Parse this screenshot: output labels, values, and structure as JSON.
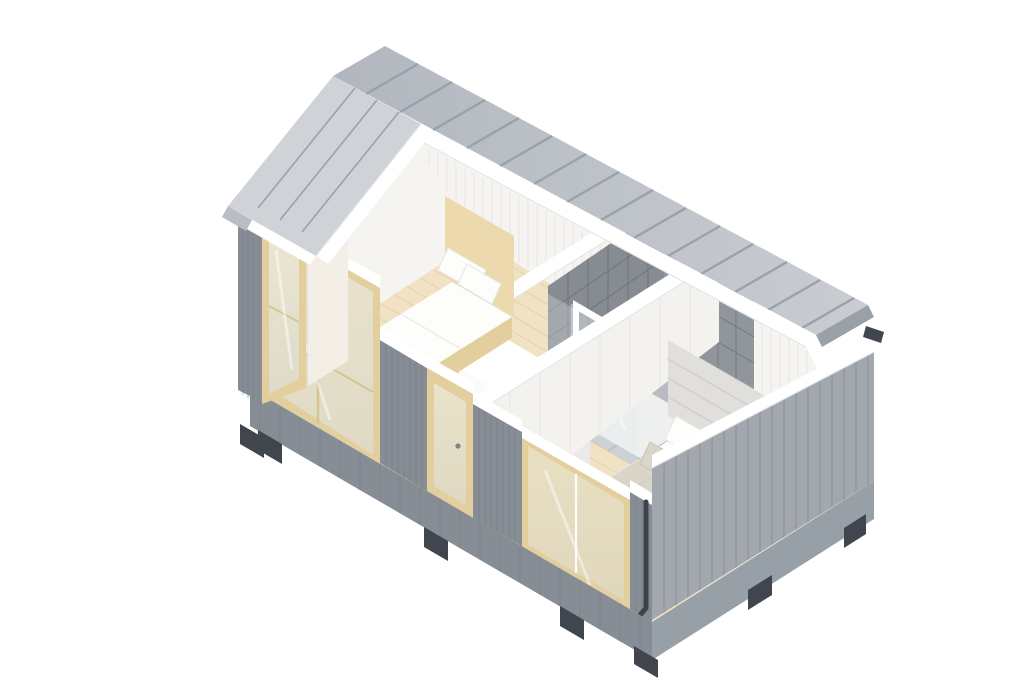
{
  "meta": {
    "description": "Isometric cutaway 3D rendering of a tiny modular house with two bedrooms and a central bathroom",
    "width_px": 1024,
    "height_px": 683
  },
  "palette": {
    "background": "#ffffff",
    "roof_metal_light": "#cfd3d8",
    "roof_metal": "#b9bec5",
    "roof_seam": "#9aa1aa",
    "roof_end_cap": "#9aa0a8",
    "trim_white": "#ffffff",
    "cut_edge_shadow": "#e4e7ea",
    "siding_gray": "#98a0a7",
    "siding_gray_dark": "#868d95",
    "siding_line": "#757c84",
    "interior_white": "#f5f4f1",
    "panel_line": "#e7e6e1",
    "gable_interior": "#f3efe6",
    "floor_wood": "#f1e2c4",
    "floor_plank_line": "#e0cda7",
    "tile_dark": "#878c93",
    "tile_dark_2": "#91969d",
    "tile_grout": "#61666d",
    "tile_floor": "#b8bcc1",
    "glass_tint": "#e4ebee",
    "wood_light": "#ecdaae",
    "wood_frame": "#e3cf9e",
    "bedding_white": "#fdfdfc",
    "bedding_greige": "#d9d6c9",
    "bedding_greige_dark": "#cbc8b9",
    "headboard_gray": "#e0dfdb",
    "rug_gray": "#d6d8d9",
    "foot_dark": "#41464e",
    "chrome": "#aeb4ba"
  },
  "scene": {
    "building": "tiny-house cutaway, gable standing-seam metal roof with front slope removed",
    "exterior": {
      "cladding": "gray vertical wood siding",
      "base": "raised platform on dark foundation feet",
      "details": [
        "white cut edges",
        "corner downspout",
        "white barge board",
        "roof end gutter hook"
      ]
    },
    "rooms": [
      {
        "name": "bedroom-1",
        "furniture": [
          "single bed",
          "tall wood headboard",
          "white duvet",
          "two white pillows"
        ],
        "features": [
          "gable-end window",
          "front glazed sliding door",
          "wood plank floor",
          "white paneled walls"
        ]
      },
      {
        "name": "bathroom",
        "furniture": [
          "walk-in shower",
          "glass shower screen",
          "chrome shower fixture",
          "white vanity unit"
        ],
        "features": [
          "dark gray wall tiles",
          "gray floor tiles",
          "small wood-framed back window"
        ]
      },
      {
        "name": "hallway",
        "furniture": [
          "white wardrobe with wood side panel"
        ],
        "features": [
          "glazed entrance door with wood frame"
        ]
      },
      {
        "name": "bedroom-2",
        "furniture": [
          "double bed",
          "upholstered channel headboard",
          "greige duvet",
          "white and greige pillows",
          "gray rug"
        ],
        "features": [
          "low-cut front glazing",
          "wood plank floor",
          "white paneled walls"
        ]
      }
    ]
  }
}
